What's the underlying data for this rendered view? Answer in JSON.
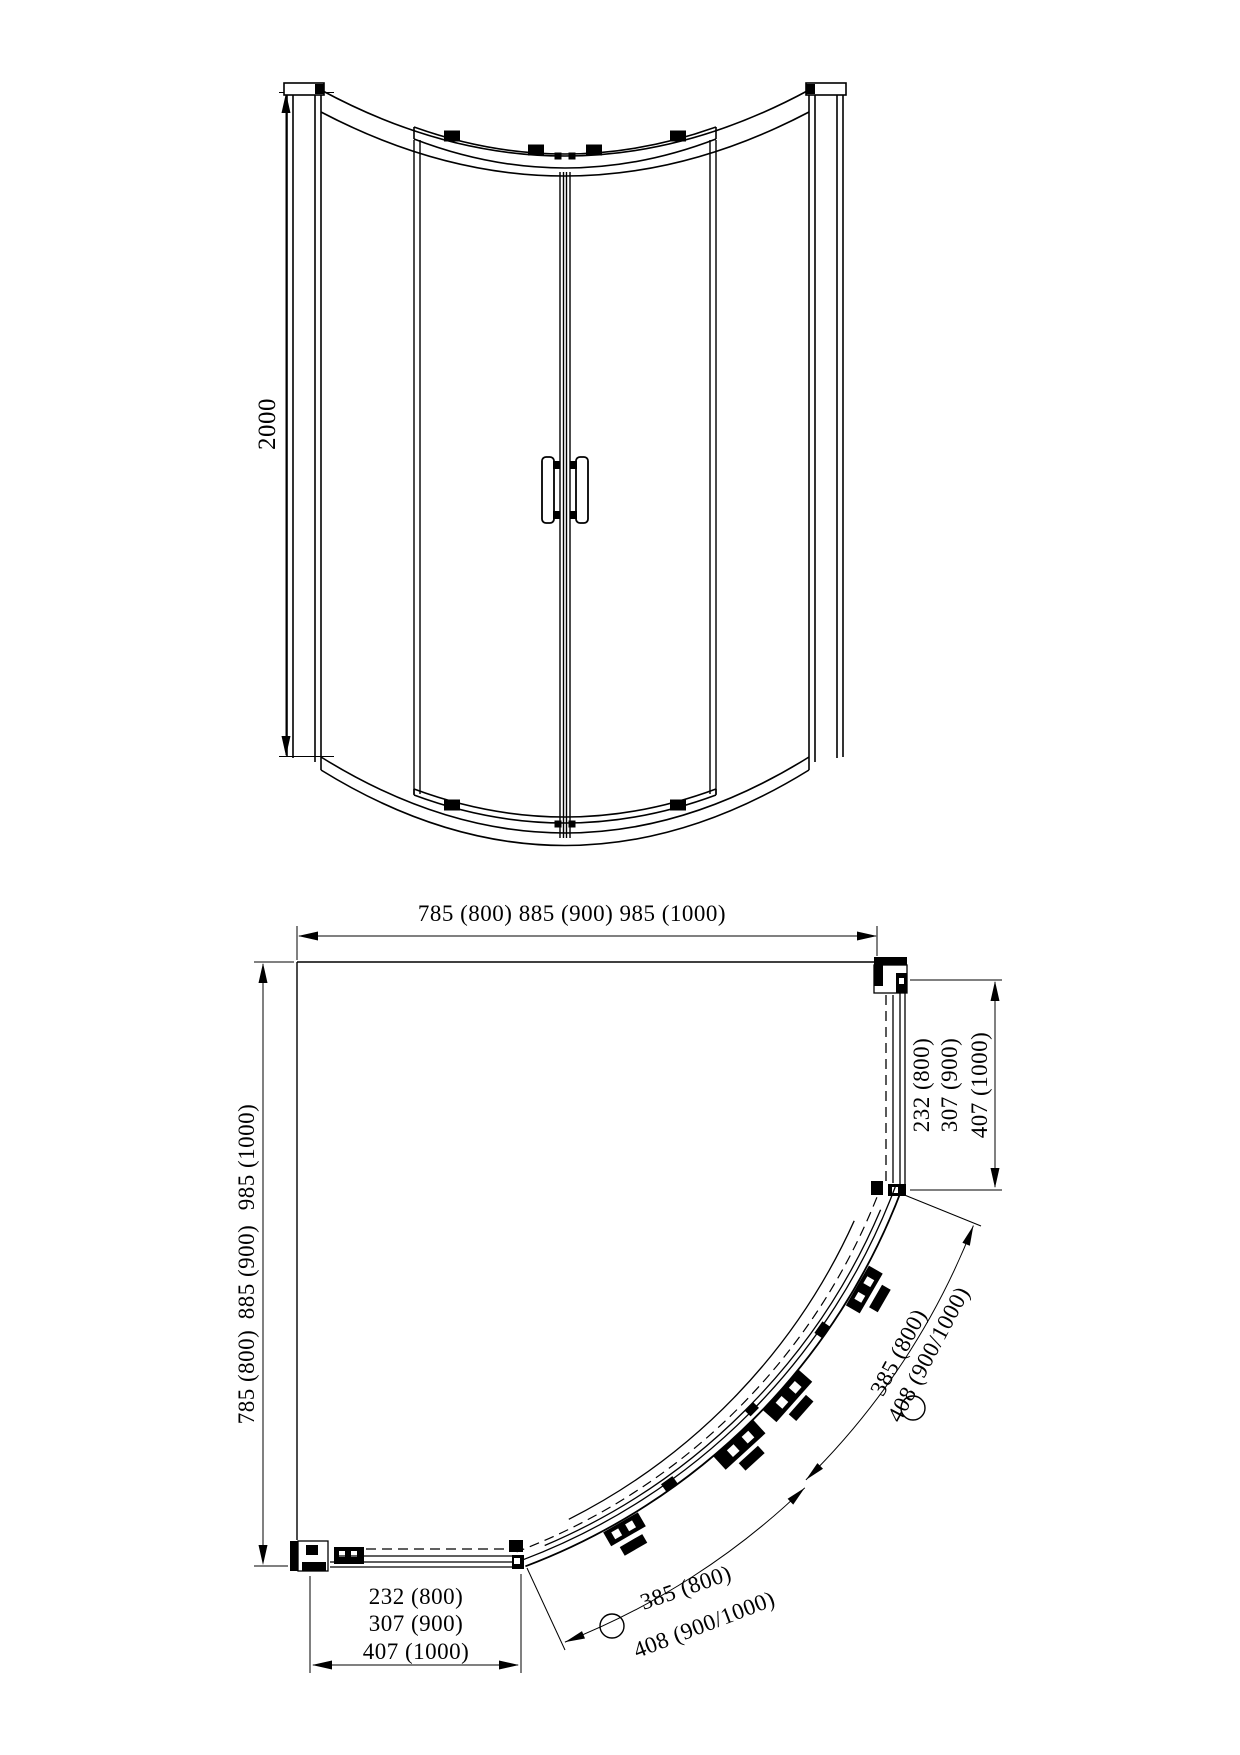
{
  "drawing": {
    "type": "shower-enclosure-quadrant-technical-drawing",
    "line_color": "#000000",
    "background_color": "#ffffff",
    "front_view": {
      "height_dim": "2000"
    },
    "plan_view": {
      "width_dim": "785 (800)  885 (900)  985 (1000)",
      "depth_dims": [
        "785 (800)",
        "885 (900)",
        "985 (1000)"
      ],
      "right_panel_dims": [
        "232 (800)",
        "307 (900)",
        "407 (1000)"
      ],
      "bottom_panel_dims": [
        "232 (800)",
        "307 (900)",
        "407 (1000)"
      ],
      "right_arc_dims": [
        "385 (800)",
        "408 (900/1000)"
      ],
      "bottom_arc_dims": [
        "385 (800)",
        "408 (900/1000)"
      ]
    }
  }
}
